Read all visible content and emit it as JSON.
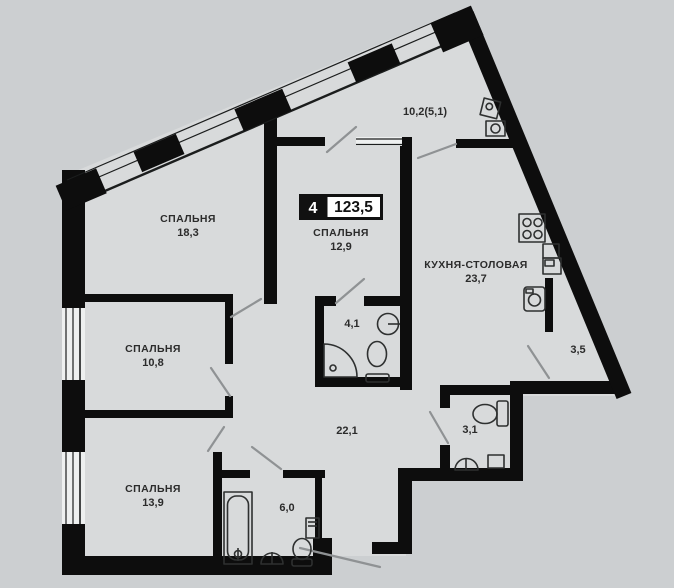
{
  "title": "Apartment floor plan",
  "badge": {
    "rooms_count": "4",
    "total_area": "123,5"
  },
  "rooms": [
    {
      "id": "bedroom-1",
      "name": "СПАЛЬНЯ",
      "area": "18,3"
    },
    {
      "id": "bedroom-2",
      "name": "СПАЛЬНЯ",
      "area": "12,9"
    },
    {
      "id": "bedroom-3",
      "name": "СПАЛЬНЯ",
      "area": "10,8"
    },
    {
      "id": "bedroom-4",
      "name": "СПАЛЬНЯ",
      "area": "13,9"
    },
    {
      "id": "kitchen-dining",
      "name": "КУХНЯ-СТОЛОВАЯ",
      "area": "23,7"
    },
    {
      "id": "balcony",
      "name": "",
      "area": "10,2(5,1)"
    },
    {
      "id": "bathroom-1",
      "name": "",
      "area": "4,1"
    },
    {
      "id": "hallway",
      "name": "",
      "area": "22,1"
    },
    {
      "id": "bathroom-2",
      "name": "",
      "area": "6,0"
    },
    {
      "id": "wc",
      "name": "",
      "area": "3,1"
    },
    {
      "id": "storage",
      "name": "",
      "area": "3,5"
    }
  ],
  "colors": {
    "background": "#cccfd1",
    "floor": "#d8dadb",
    "wall": "#0d0d0d",
    "text": "#2b2b2b",
    "door_line": "#8f9294",
    "badge_bg": "#111111",
    "badge_area_bg": "#ffffff"
  }
}
